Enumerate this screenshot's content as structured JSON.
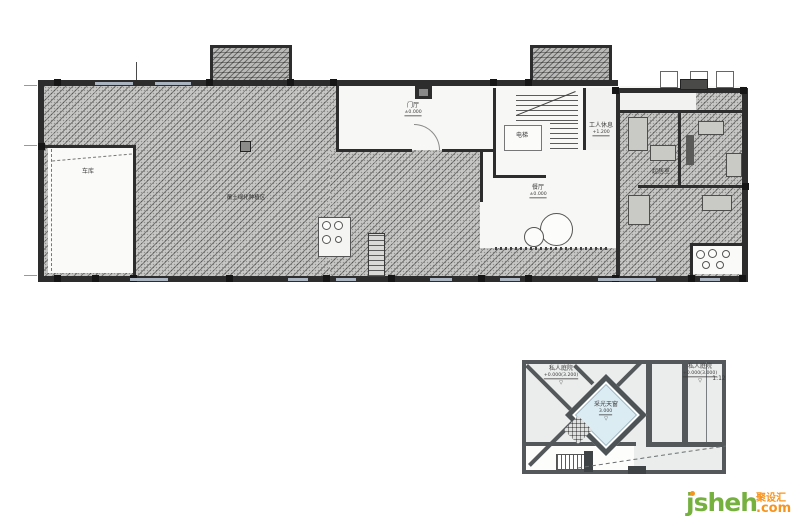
{
  "main_plan": {
    "labels": {
      "garage": {
        "text": "车库"
      },
      "planting": {
        "text": "覆土绿化种植区"
      },
      "hall": {
        "text": "门厅",
        "elevation": "±0.000"
      },
      "stair": {
        "text": "电梯"
      },
      "service": {
        "text": "工人休息",
        "elevation": "+1.200"
      },
      "dining": {
        "text": "餐厅",
        "elevation": "±0.000"
      },
      "storage": {
        "text": "起居室"
      }
    }
  },
  "small_plan": {
    "labels": {
      "courtyard_left": {
        "text": "私人庭院",
        "elevation": "+0.000(3.200)"
      },
      "courtyard_right": {
        "text": "私人庭院",
        "elevation": "+0.000(3.000)"
      },
      "slope": "1:12",
      "skylight": {
        "text": "采光天窗",
        "elevation": "3.000"
      }
    }
  },
  "watermark": {
    "brand": "jsheh",
    "suffix": ".com",
    "chinese": "聚设汇"
  },
  "colors": {
    "hatch_fill": "#c7c7c5",
    "wall": "#2d2d2d",
    "skylight_blue": "#dcecf3",
    "brand_green": "#76b140",
    "brand_orange": "#f7941e"
  }
}
